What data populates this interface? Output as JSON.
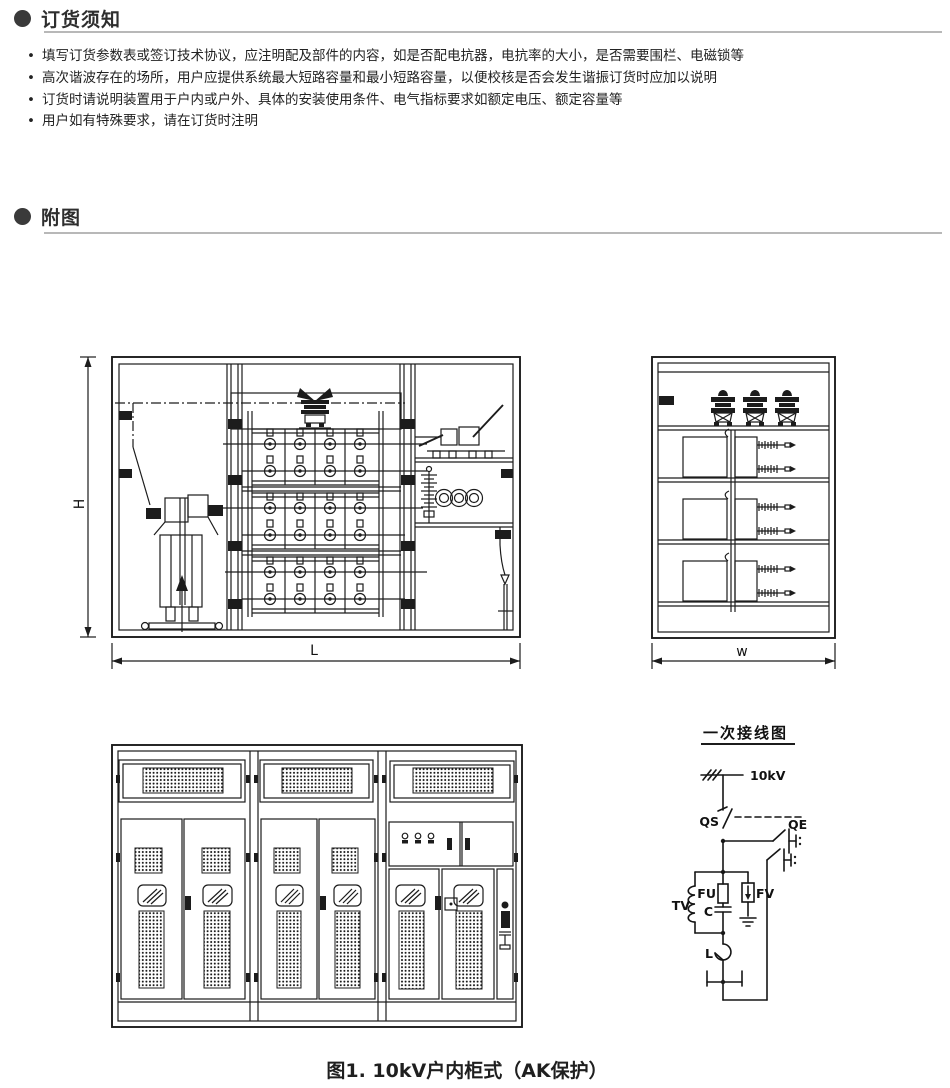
{
  "notice": {
    "title": "订货须知",
    "marker": "•",
    "bullets": [
      "填写订货参数表或签订技术协议，应注明配及部件的内容，如是否配电抗器，电抗率的大小，是否需要围栏、电磁锁等",
      "高次谐波存在的场所，用户应提供系统最大短路容量和最小短路容量，以便校核是否会发生谐振订货时应加以说明",
      "订货时请说明装置用于户内或户外、具体的安装使用条件、电气指标要求如额定电压、额定容量等",
      "用户如有特殊要求，请在订货时注明"
    ]
  },
  "figures": {
    "title": "附图"
  },
  "interior_view": {
    "dim_height": "H",
    "dim_length": "L"
  },
  "side_view": {
    "dim_width": "w"
  },
  "schematic": {
    "title": "一次接线图",
    "labels": {
      "source": "10kV",
      "disconnector": "QS",
      "earthing_switch": "QE",
      "voltage_transformer": "TV",
      "fuse": "FU",
      "capacitor": "C",
      "arrester": "FV",
      "reactor": "L"
    }
  },
  "caption": "图1. 10kV户内柜式（AK保护）",
  "colors": {
    "ink": "#1c1c1c",
    "heading": "#3a3a3a",
    "rule": "#b8b8b8"
  }
}
